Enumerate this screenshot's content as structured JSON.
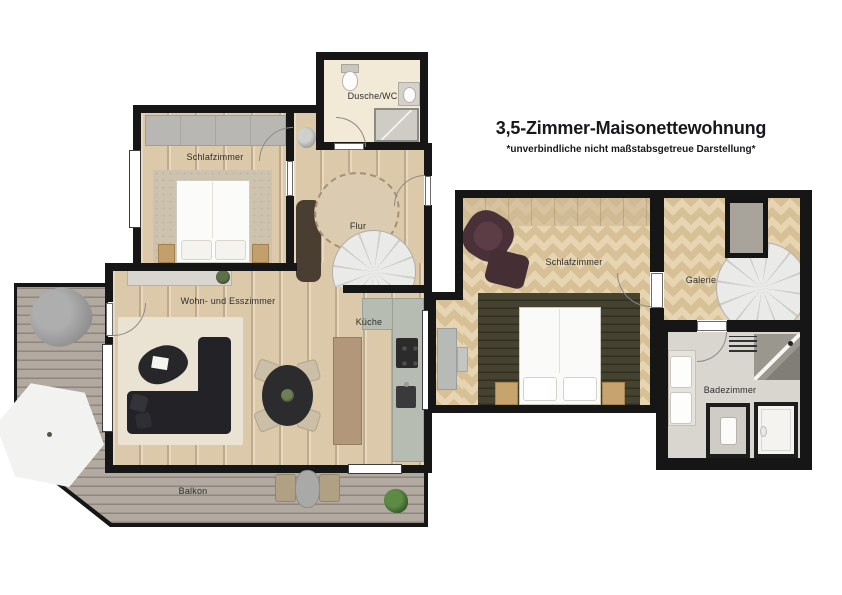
{
  "header": {
    "title": "3,5-Zimmer-Maisonettewohnung",
    "subtitle": "*unverbindliche nicht maßstabsgetreue Darstellung*"
  },
  "lower_floor": {
    "rooms": {
      "schlafzimmer": {
        "label": "Schlafzimmer"
      },
      "dusche_wc": {
        "label": "Dusche/WC"
      },
      "flur": {
        "label": "Flur"
      },
      "wohn_esszimmer": {
        "label": "Wohn- und Esszimmer"
      },
      "kueche": {
        "label": "Küche"
      },
      "balkon": {
        "label": "Balkon"
      }
    },
    "features": [
      "bed",
      "wardrobe",
      "spiral-staircase",
      "sofa",
      "coffee-table",
      "dining-table",
      "kitchen-counter",
      "shower",
      "toilet",
      "sink",
      "parasol",
      "beanbag",
      "bistro-set",
      "plant"
    ]
  },
  "upper_floor": {
    "rooms": {
      "schlafzimmer": {
        "label": "Schlafzimmer"
      },
      "galerie": {
        "label": "Galerie"
      },
      "badezimmer": {
        "label": "Badezimmer"
      }
    },
    "features": [
      "bed",
      "armchair",
      "ottoman",
      "desk",
      "spiral-staircase",
      "stairwell-void",
      "double-sink",
      "corner-shower",
      "bathtub",
      "toilet",
      "radiator"
    ]
  },
  "colors": {
    "wall": "#161616",
    "wood_floor": "#dcc9a9",
    "herringbone_floor": "#e6d4b2",
    "deck": "#b2aaa0",
    "bath_tile": "#d9d5cf",
    "cream_floor": "#f2e9d7"
  }
}
